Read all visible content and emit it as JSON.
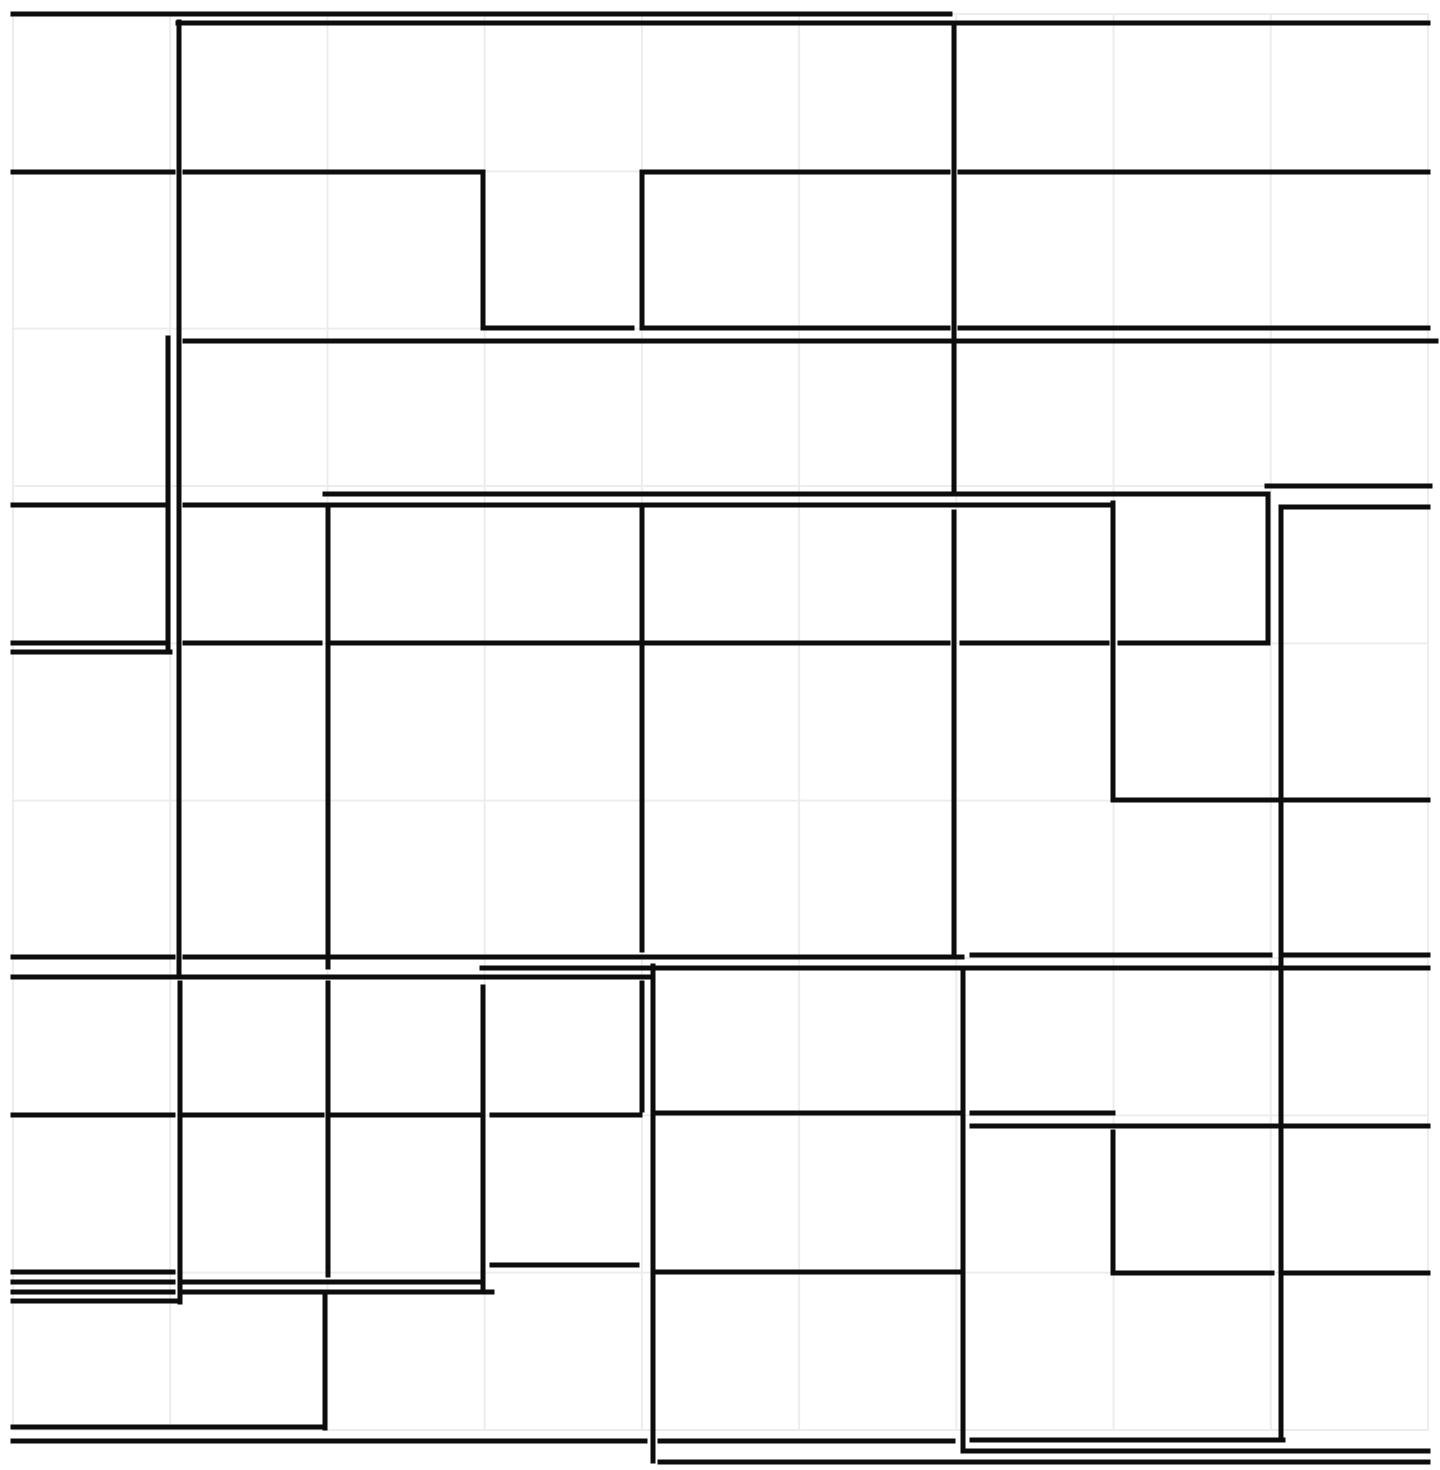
{
  "meta": {
    "description": "Abstract monochrome maze-like line drawing: thick black orthogonal wall segments over a faint light-gray grid on a white background",
    "canvas_width": 1440,
    "canvas_height": 1470
  },
  "style": {
    "background_color": "#ffffff",
    "wall_color": "#0d0d0d",
    "wall_width": 5,
    "grid_color": "#ededed",
    "grid_width": 2
  },
  "grid": {
    "x_start": 13,
    "x_end": 1428,
    "y_start": 14,
    "y_end": 1430,
    "x_line_count": 10,
    "y_line_count": 10
  },
  "segments": {
    "horizontal": [
      {
        "y": 14,
        "x1": 13,
        "x2": 950
      },
      {
        "y": 23,
        "x1": 178,
        "x2": 1428
      },
      {
        "y": 172,
        "x1": 13,
        "x2": 173
      },
      {
        "y": 172,
        "x1": 185,
        "x2": 483
      },
      {
        "y": 172,
        "x1": 642,
        "x2": 948
      },
      {
        "y": 172,
        "x1": 960,
        "x2": 1428
      },
      {
        "y": 328,
        "x1": 483,
        "x2": 632
      },
      {
        "y": 328,
        "x1": 647,
        "x2": 948
      },
      {
        "y": 328,
        "x1": 960,
        "x2": 1428
      },
      {
        "y": 341,
        "x1": 185,
        "x2": 1436
      },
      {
        "y": 486,
        "x1": 1267,
        "x2": 1430
      },
      {
        "y": 494,
        "x1": 325,
        "x2": 1268
      },
      {
        "y": 505,
        "x1": 13,
        "x2": 168
      },
      {
        "y": 505,
        "x1": 185,
        "x2": 1113
      },
      {
        "y": 507,
        "x1": 1281,
        "x2": 1428
      },
      {
        "y": 643,
        "x1": 13,
        "x2": 168
      },
      {
        "y": 643,
        "x1": 185,
        "x2": 320
      },
      {
        "y": 643,
        "x1": 333,
        "x2": 948
      },
      {
        "y": 643,
        "x1": 962,
        "x2": 1107
      },
      {
        "y": 643,
        "x1": 1120,
        "x2": 1268
      },
      {
        "y": 652,
        "x1": 13,
        "x2": 170
      },
      {
        "y": 800,
        "x1": 1113,
        "x2": 1428
      },
      {
        "y": 957,
        "x1": 13,
        "x2": 173
      },
      {
        "y": 957,
        "x1": 185,
        "x2": 962
      },
      {
        "y": 955,
        "x1": 972,
        "x2": 1270
      },
      {
        "y": 955,
        "x1": 1285,
        "x2": 1428
      },
      {
        "y": 968,
        "x1": 482,
        "x2": 1428
      },
      {
        "y": 977,
        "x1": 13,
        "x2": 653
      },
      {
        "y": 1113,
        "x1": 657,
        "x2": 962
      },
      {
        "y": 1113,
        "x1": 972,
        "x2": 1113
      },
      {
        "y": 1115,
        "x1": 13,
        "x2": 173
      },
      {
        "y": 1115,
        "x1": 185,
        "x2": 322
      },
      {
        "y": 1115,
        "x1": 333,
        "x2": 478
      },
      {
        "y": 1115,
        "x1": 492,
        "x2": 640
      },
      {
        "y": 1126,
        "x1": 972,
        "x2": 1428
      },
      {
        "y": 1265,
        "x1": 492,
        "x2": 637
      },
      {
        "y": 1272,
        "x1": 13,
        "x2": 173
      },
      {
        "y": 1272,
        "x1": 657,
        "x2": 960
      },
      {
        "y": 1273,
        "x1": 1113,
        "x2": 1272
      },
      {
        "y": 1273,
        "x1": 1285,
        "x2": 1428
      },
      {
        "y": 1282,
        "x1": 13,
        "x2": 173
      },
      {
        "y": 1282,
        "x1": 185,
        "x2": 483
      },
      {
        "y": 1292,
        "x1": 13,
        "x2": 173
      },
      {
        "y": 1292,
        "x1": 185,
        "x2": 492
      },
      {
        "y": 1301,
        "x1": 13,
        "x2": 180
      },
      {
        "y": 1427,
        "x1": 13,
        "x2": 322
      },
      {
        "y": 1441,
        "x1": 13,
        "x2": 645
      },
      {
        "y": 1441,
        "x1": 660,
        "x2": 953
      },
      {
        "y": 1440,
        "x1": 972,
        "x2": 1283
      },
      {
        "y": 1451,
        "x1": 963,
        "x2": 1428
      },
      {
        "y": 1462,
        "x1": 660,
        "x2": 1428
      }
    ],
    "vertical": [
      {
        "x": 179,
        "y1": 22,
        "y2": 972
      },
      {
        "x": 168,
        "y1": 338,
        "y2": 652
      },
      {
        "x": 483,
        "y1": 172,
        "y2": 328
      },
      {
        "x": 642,
        "y1": 172,
        "y2": 328
      },
      {
        "x": 954,
        "y1": 23,
        "y2": 490
      },
      {
        "x": 954,
        "y1": 512,
        "y2": 952
      },
      {
        "x": 328,
        "y1": 510,
        "y2": 967
      },
      {
        "x": 642,
        "y1": 510,
        "y2": 950
      },
      {
        "x": 1113,
        "y1": 503,
        "y2": 800
      },
      {
        "x": 1268,
        "y1": 494,
        "y2": 642
      },
      {
        "x": 1281,
        "y1": 507,
        "y2": 1438
      },
      {
        "x": 963,
        "y1": 970,
        "y2": 1450
      },
      {
        "x": 180,
        "y1": 983,
        "y2": 1302
      },
      {
        "x": 328,
        "y1": 983,
        "y2": 1275
      },
      {
        "x": 325,
        "y1": 1297,
        "y2": 1428
      },
      {
        "x": 483,
        "y1": 987,
        "y2": 1290
      },
      {
        "x": 642,
        "y1": 983,
        "y2": 1110
      },
      {
        "x": 653,
        "y1": 966,
        "y2": 1461
      },
      {
        "x": 1113,
        "y1": 1132,
        "y2": 1272
      }
    ]
  }
}
